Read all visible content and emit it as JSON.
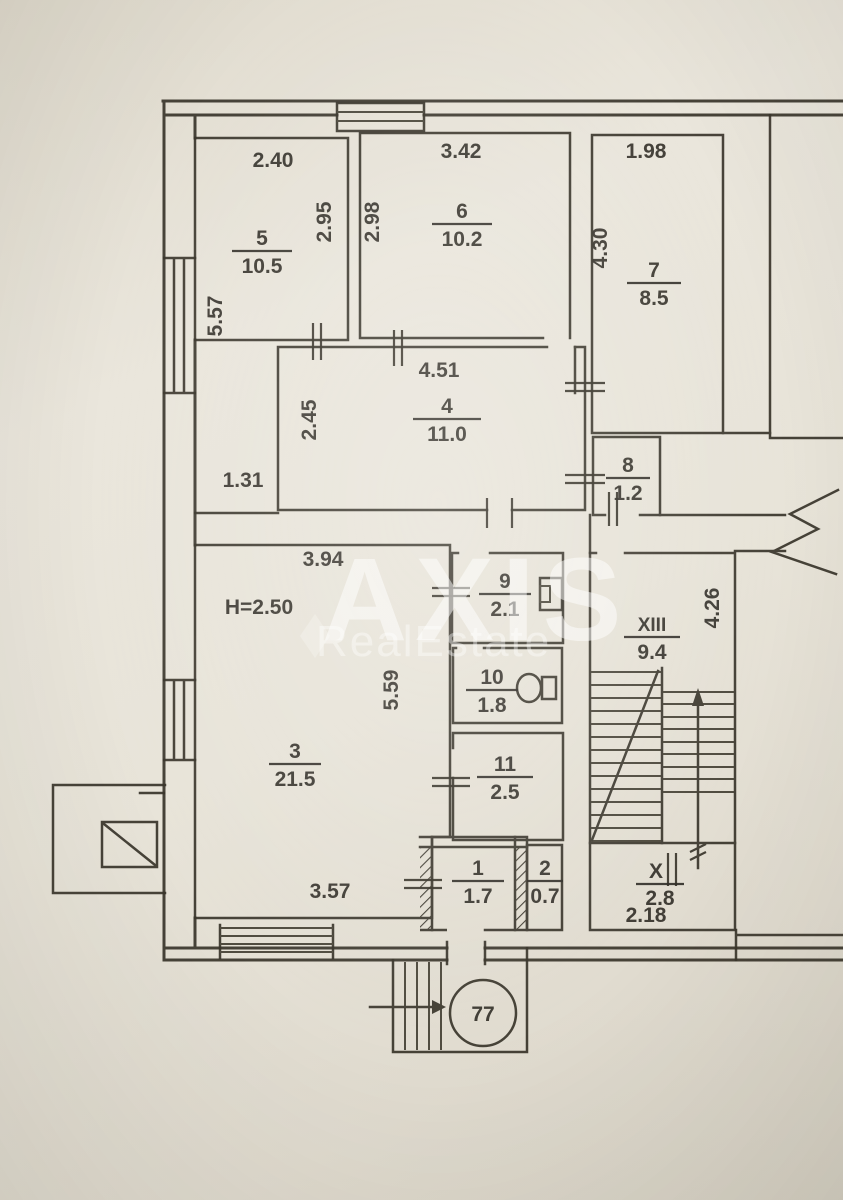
{
  "watermark": {
    "brand": "AXIS",
    "subtitle": "RealEstate"
  },
  "entrance": {
    "number": "77"
  },
  "rooms": [
    {
      "num": "5",
      "area": "10.5"
    },
    {
      "num": "6",
      "area": "10.2"
    },
    {
      "num": "7",
      "area": "8.5"
    },
    {
      "num": "4",
      "area": "11.0"
    },
    {
      "num": "8",
      "area": "1.2"
    },
    {
      "num": "9",
      "area": "2.1"
    },
    {
      "num": "10",
      "area": "1.8"
    },
    {
      "num": "11",
      "area": "2.5"
    },
    {
      "num": "3",
      "area": "21.5"
    },
    {
      "num": "1",
      "area": "1.7"
    },
    {
      "num": "2",
      "area": "0.7"
    },
    {
      "num": "XIII",
      "area": "9.4"
    },
    {
      "num": "X",
      "area": "2.8"
    }
  ],
  "dims": {
    "r5_width": "2.40",
    "r5_depth": "2.95",
    "r5_side": "5.57",
    "r6_width": "3.42",
    "r6_depth": "2.98",
    "r7_width": "1.98",
    "r7_depth": "4.30",
    "r4_width": "4.51",
    "r4_depth": "2.45",
    "hall_nook": "1.31",
    "r3_top": "3.94",
    "r3_height_note": "H=2.50",
    "r3_depth": "5.59",
    "r3_bottom": "3.57",
    "stair_depth": "4.26",
    "stair_bottom_width": "2.18"
  }
}
